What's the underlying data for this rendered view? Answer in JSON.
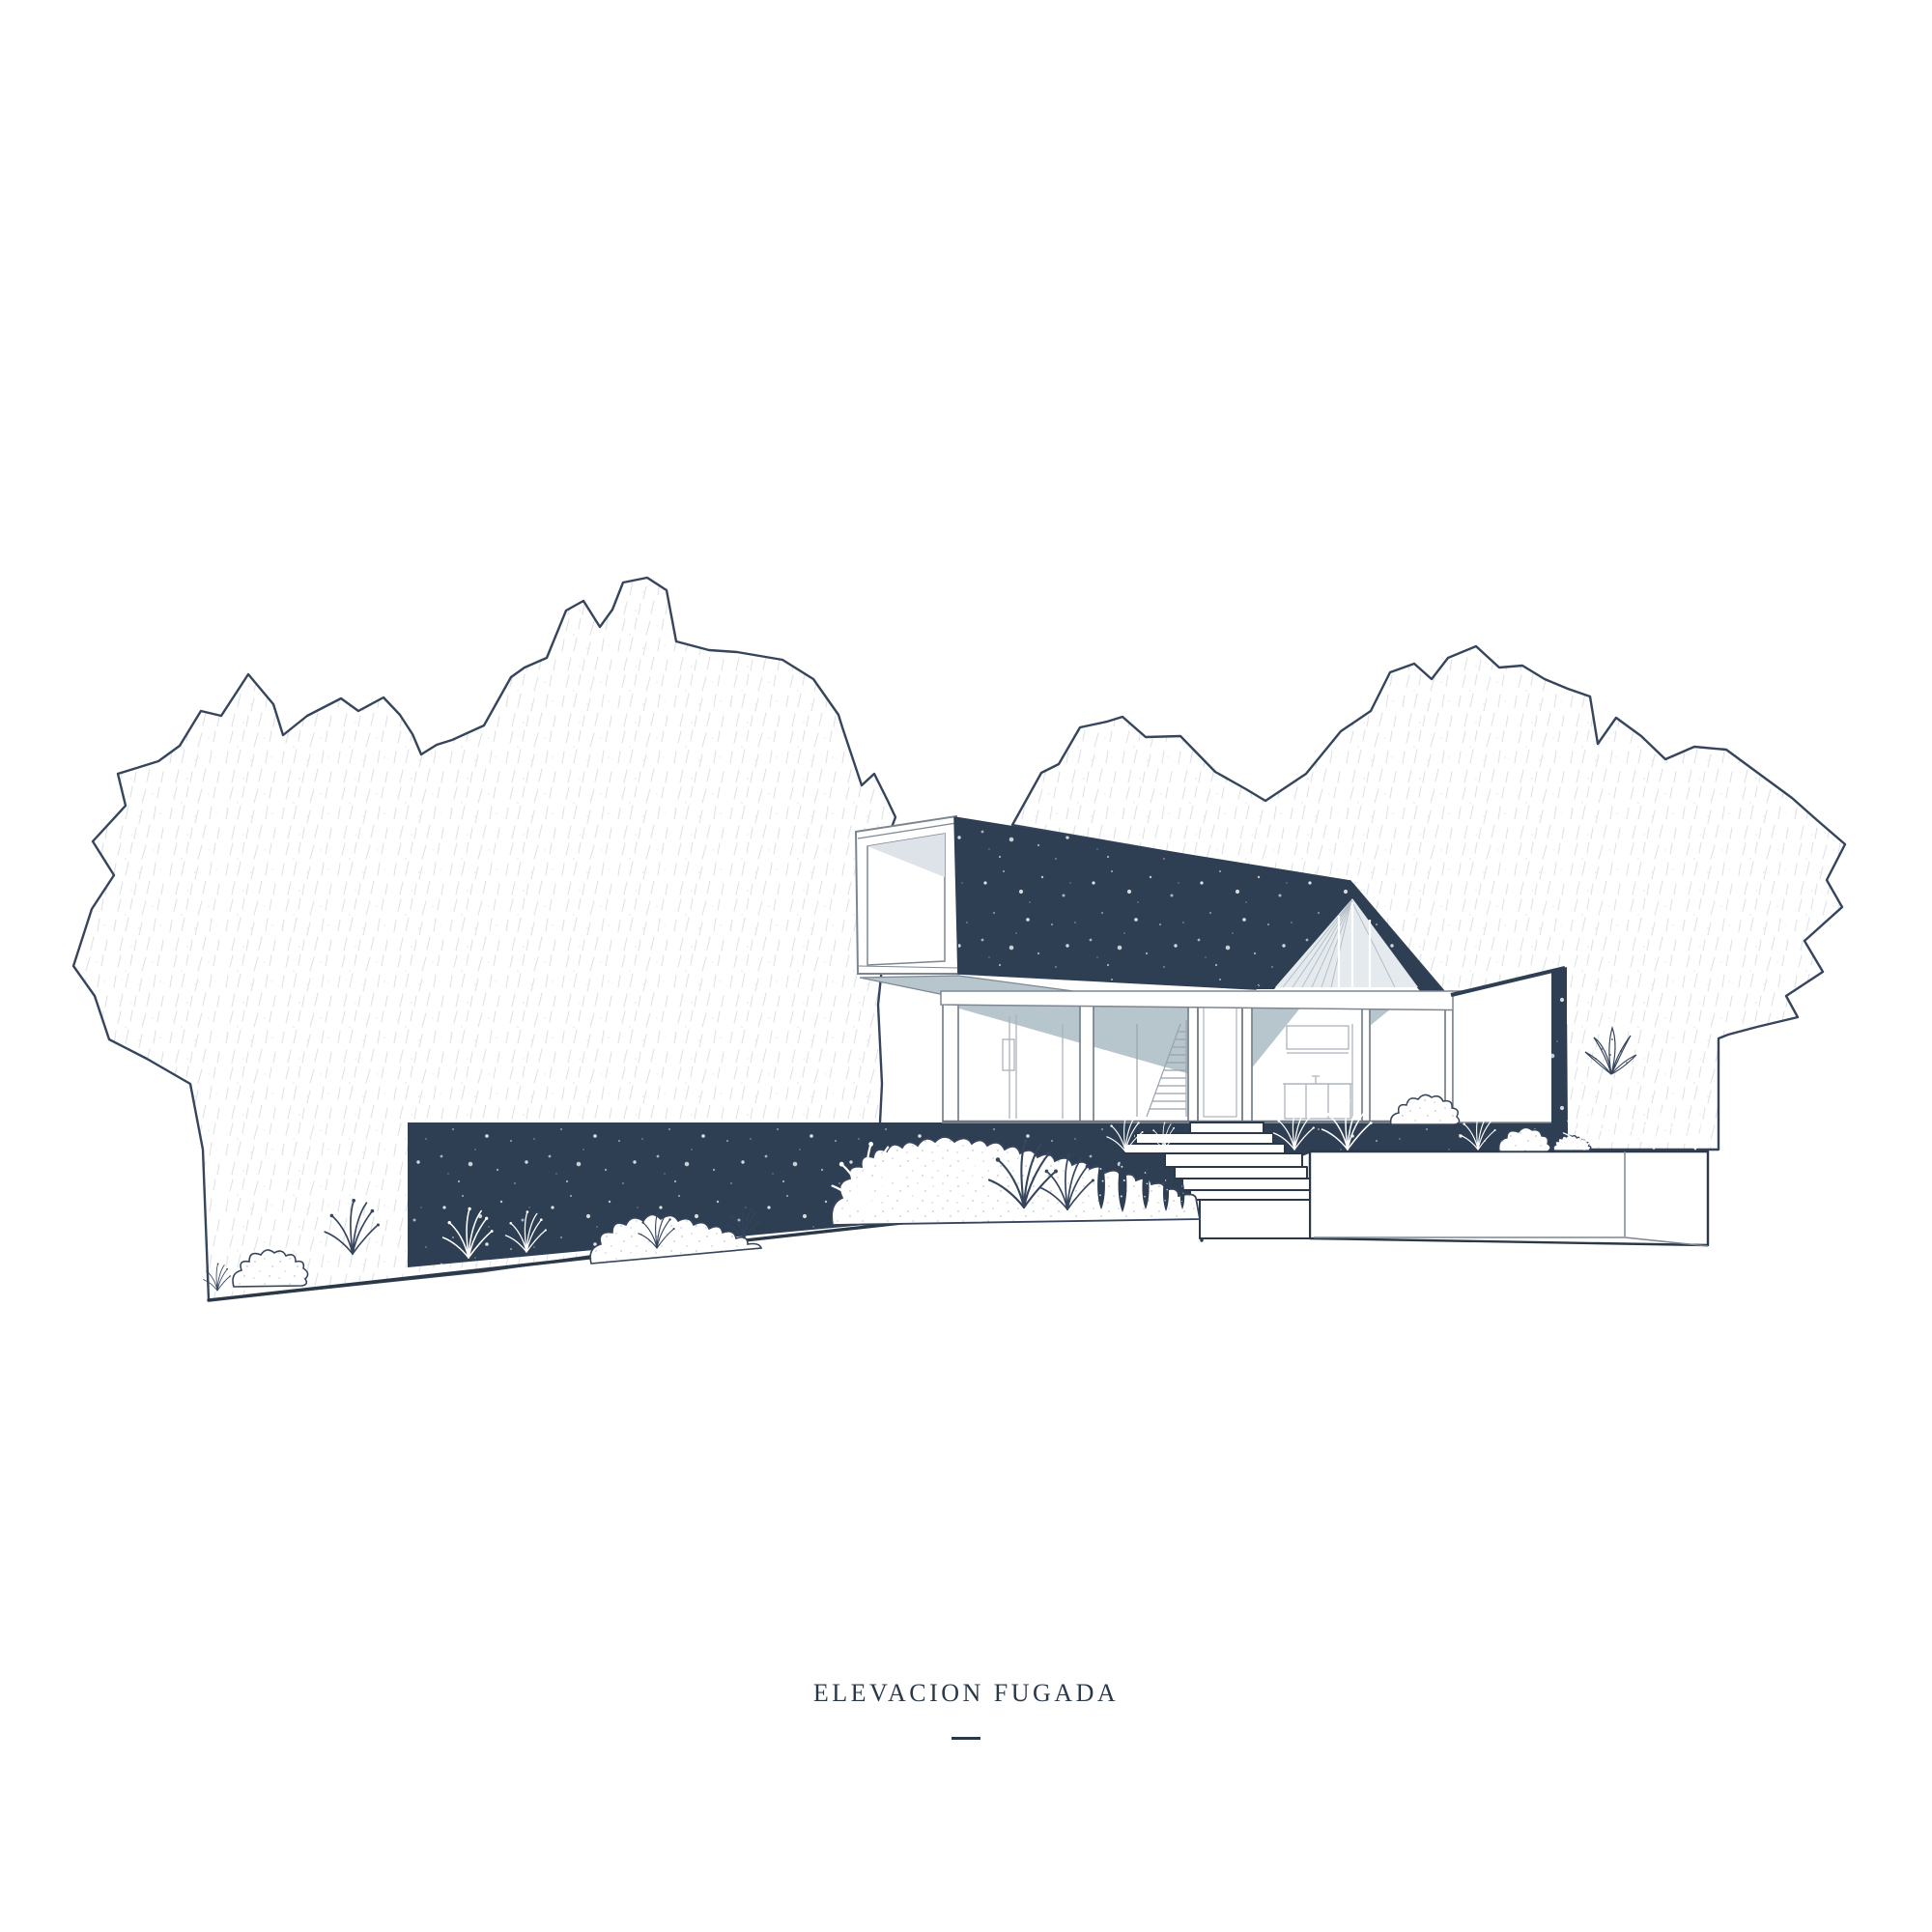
{
  "title": {
    "text": "ELEVACION FUGADA"
  },
  "palette": {
    "navy": "#2e3e53",
    "ink": "#36455c",
    "ink_dark": "#2b3848",
    "line_gray": "#7d8691",
    "line_light": "#aab3bc",
    "soffit": "#b7c5cd",
    "ceiling": "#dde3e8",
    "glazing": "#e4eaee",
    "hatch_stroke": "#c9ced7",
    "paper": "#ffffff"
  },
  "scene": {
    "type": "architectural-perspective-elevation",
    "elements": [
      "left-tree-mass",
      "right-tree-mass",
      "hillside-band",
      "ground-slope-line",
      "cantilever-volume",
      "main-roof",
      "gable-window",
      "eave-fascia",
      "glass-facade",
      "entry-door",
      "interior-stair",
      "kitchen-interior",
      "right-wing-wall",
      "entry-steps",
      "lower-terrace",
      "planting-beds",
      "grass-tufts",
      "conifer-shrubs",
      "drawing-title"
    ]
  }
}
